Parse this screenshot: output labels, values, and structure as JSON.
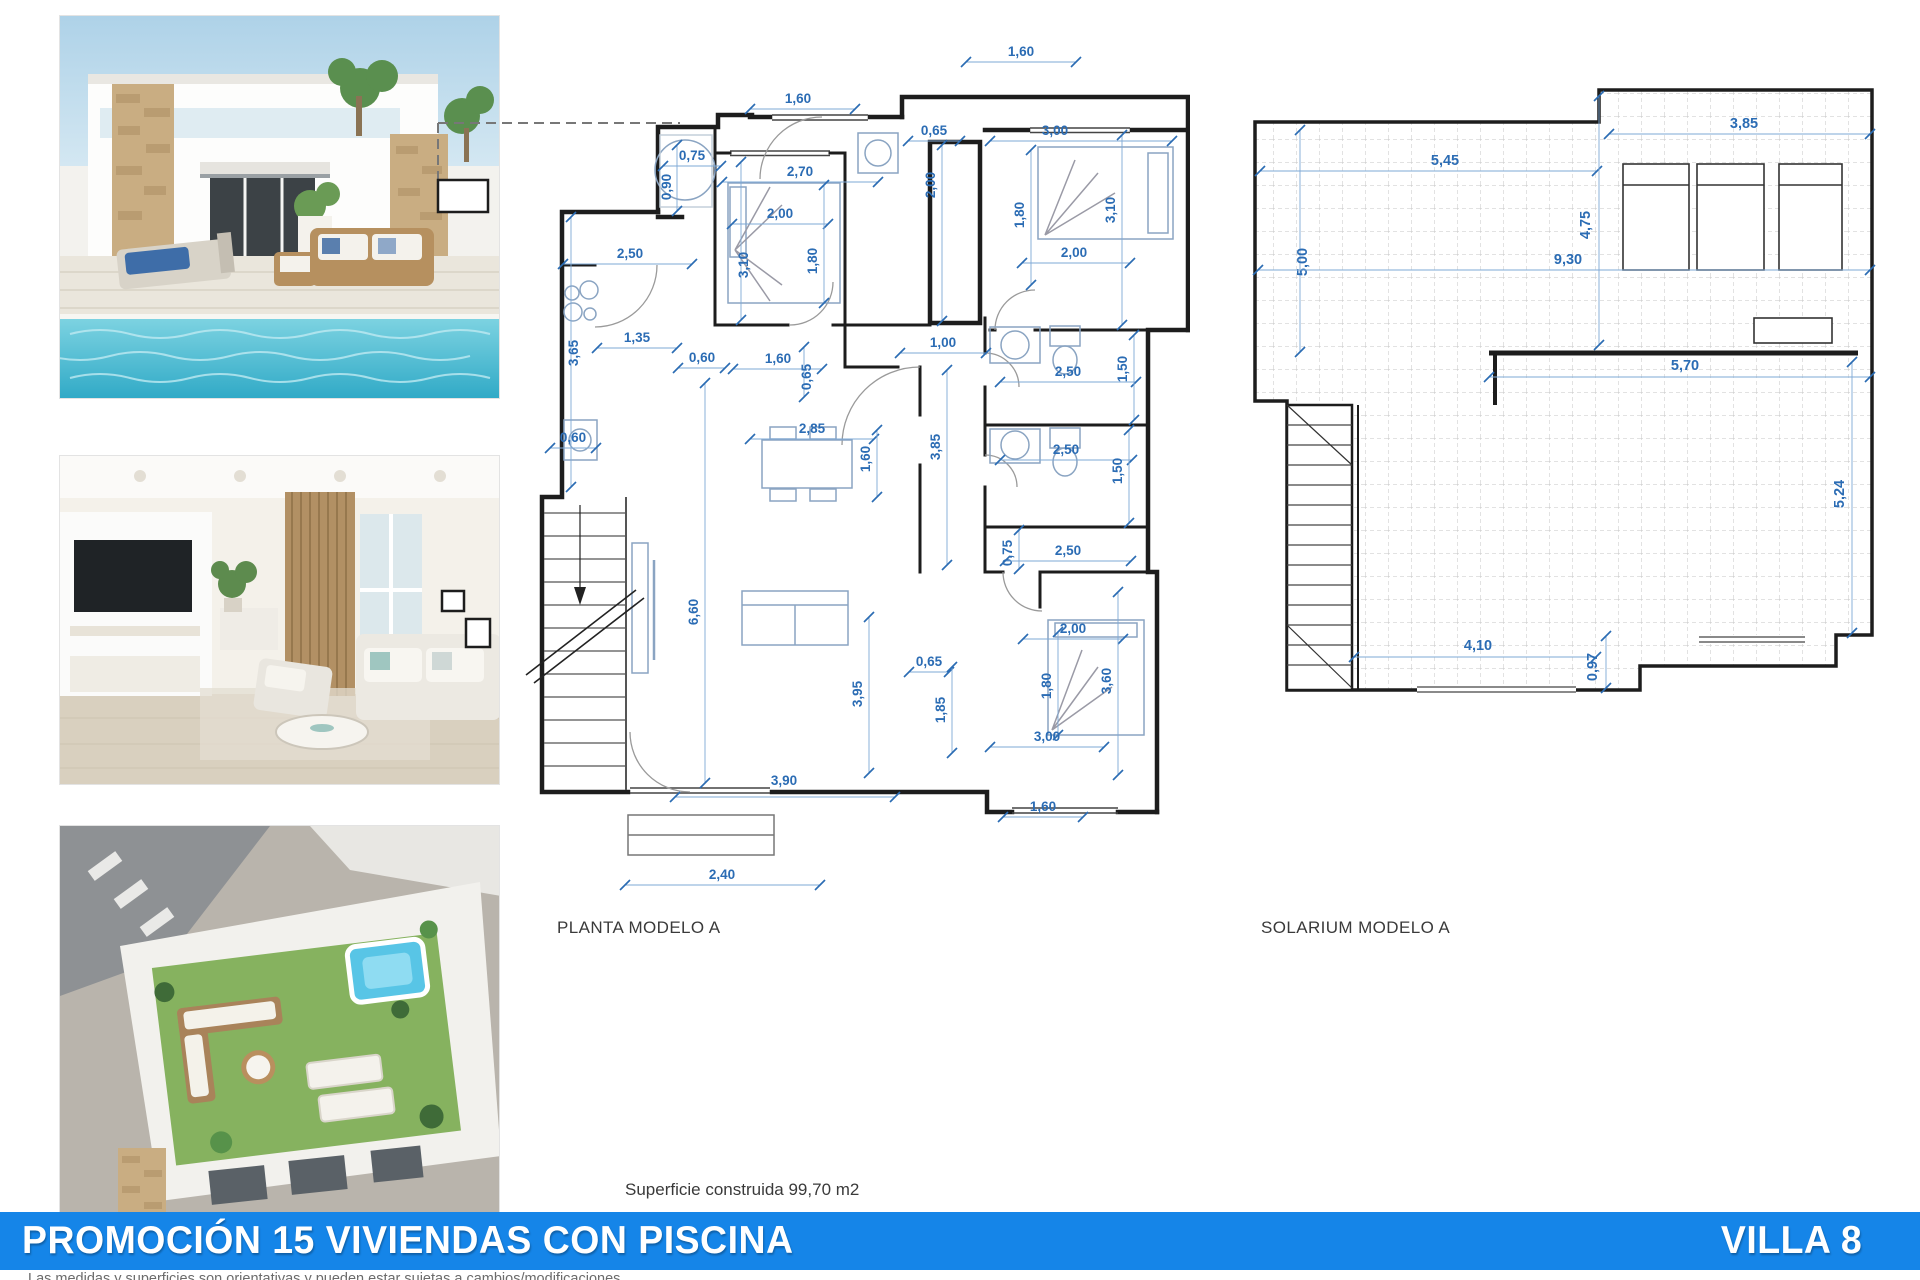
{
  "photos": [
    {
      "label": "villa-exterior-with-pool"
    },
    {
      "label": "living-room-interior"
    },
    {
      "label": "rooftop-solarium-aerial-view"
    }
  ],
  "planta": {
    "title": "PLANTA MODELO A",
    "scale_note": "dimensions in metres",
    "dims": [
      {
        "t": "1,60",
        "x": 591,
        "y": 21,
        "l": [
          536,
          27,
          646,
          27
        ]
      },
      {
        "t": "1,60",
        "x": 368,
        "y": 68,
        "l": [
          320,
          74,
          425,
          74
        ]
      },
      {
        "t": "0,65",
        "x": 504,
        "y": 100,
        "l": [
          478,
          106,
          530,
          106
        ]
      },
      {
        "t": "3,00",
        "x": 625,
        "y": 100,
        "l": [
          560,
          106,
          742,
          106
        ]
      },
      {
        "t": "0,75",
        "x": 262,
        "y": 125,
        "l": [
          233,
          131,
          291,
          131
        ]
      },
      {
        "t": "0,90",
        "x": 241,
        "y": 152,
        "r": -90,
        "l": [
          247,
          110,
          247,
          176
        ]
      },
      {
        "t": "2,70",
        "x": 370,
        "y": 141,
        "l": [
          292,
          147,
          448,
          147
        ]
      },
      {
        "t": "2,00",
        "x": 505,
        "y": 150,
        "r": -90,
        "l": [
          512,
          110,
          512,
          286
        ]
      },
      {
        "t": "1,80",
        "x": 594,
        "y": 180,
        "r": -90,
        "l": [
          601,
          115,
          601,
          250
        ]
      },
      {
        "t": "3,10",
        "x": 685,
        "y": 175,
        "r": -90,
        "l": [
          692,
          100,
          692,
          290
        ]
      },
      {
        "t": "2,00",
        "x": 644,
        "y": 222,
        "l": [
          592,
          228,
          700,
          228
        ]
      },
      {
        "t": "2,00",
        "x": 350,
        "y": 183,
        "l": [
          302,
          189,
          398,
          189
        ]
      },
      {
        "t": "3,10",
        "x": 318,
        "y": 230,
        "r": -90,
        "l": [
          311,
          127,
          311,
          285
        ]
      },
      {
        "t": "1,80",
        "x": 387,
        "y": 226,
        "r": -90,
        "l": [
          394,
          150,
          394,
          268
        ]
      },
      {
        "t": "2,50",
        "x": 200,
        "y": 223,
        "l": [
          133,
          229,
          262,
          229
        ]
      },
      {
        "t": "1,35",
        "x": 207,
        "y": 307,
        "l": [
          167,
          313,
          247,
          313
        ]
      },
      {
        "t": "3,65",
        "x": 148,
        "y": 318,
        "r": -90,
        "l": [
          141,
          182,
          141,
          452
        ]
      },
      {
        "t": "0,60",
        "x": 272,
        "y": 327,
        "l": [
          248,
          333,
          295,
          333
        ]
      },
      {
        "t": "1,60",
        "x": 348,
        "y": 328,
        "l": [
          303,
          334,
          392,
          334
        ]
      },
      {
        "t": "0,65",
        "x": 381,
        "y": 342,
        "r": -90,
        "l": [
          374,
          312,
          374,
          362
        ]
      },
      {
        "t": "1,00",
        "x": 513,
        "y": 312,
        "l": [
          470,
          318,
          556,
          318
        ]
      },
      {
        "t": "2,50",
        "x": 638,
        "y": 341,
        "l": [
          570,
          347,
          706,
          347
        ]
      },
      {
        "t": "1,50",
        "x": 697,
        "y": 334,
        "r": -90,
        "l": [
          704,
          300,
          704,
          385
        ]
      },
      {
        "t": "0,60",
        "x": 143,
        "y": 407,
        "l": [
          120,
          413,
          166,
          413
        ]
      },
      {
        "t": "2,85",
        "x": 382,
        "y": 398,
        "l": [
          320,
          404,
          444,
          404
        ]
      },
      {
        "t": "1,60",
        "x": 440,
        "y": 424,
        "r": -90,
        "l": [
          447,
          395,
          447,
          462
        ]
      },
      {
        "t": "3,85",
        "x": 510,
        "y": 412,
        "r": -90,
        "l": [
          517,
          335,
          517,
          530
        ]
      },
      {
        "t": "2,50",
        "x": 636,
        "y": 419,
        "l": [
          570,
          425,
          702,
          425
        ]
      },
      {
        "t": "1,50",
        "x": 692,
        "y": 436,
        "r": -90,
        "l": [
          699,
          395,
          699,
          488
        ]
      },
      {
        "t": "0,75",
        "x": 582,
        "y": 518,
        "r": -90,
        "l": [
          589,
          495,
          589,
          534
        ]
      },
      {
        "t": "2,50",
        "x": 638,
        "y": 520,
        "l": [
          575,
          526,
          701,
          526
        ]
      },
      {
        "t": "2,00",
        "x": 643,
        "y": 598,
        "l": [
          593,
          604,
          693,
          604
        ]
      },
      {
        "t": "1,80",
        "x": 621,
        "y": 651,
        "r": -90,
        "l": [
          628,
          597,
          628,
          700
        ]
      },
      {
        "t": "3,60",
        "x": 681,
        "y": 646,
        "r": -90,
        "l": [
          688,
          557,
          688,
          740
        ]
      },
      {
        "t": "3,00",
        "x": 617,
        "y": 706,
        "l": [
          560,
          712,
          674,
          712
        ]
      },
      {
        "t": "1,60",
        "x": 613,
        "y": 776,
        "l": [
          573,
          782,
          653,
          782
        ]
      },
      {
        "t": "0,65",
        "x": 499,
        "y": 631,
        "l": [
          479,
          637,
          519,
          637
        ]
      },
      {
        "t": "1,85",
        "x": 515,
        "y": 675,
        "r": -90,
        "l": [
          522,
          632,
          522,
          718
        ]
      },
      {
        "t": "3,95",
        "x": 432,
        "y": 659,
        "r": -90,
        "l": [
          439,
          582,
          439,
          738
        ]
      },
      {
        "t": "6,60",
        "x": 268,
        "y": 577,
        "r": -90,
        "l": [
          275,
          348,
          275,
          748
        ]
      },
      {
        "t": "3,90",
        "x": 354,
        "y": 750,
        "l": [
          245,
          762,
          465,
          762
        ]
      },
      {
        "t": "2,40",
        "x": 292,
        "y": 844,
        "l": [
          195,
          850,
          390,
          850
        ]
      }
    ]
  },
  "solarium": {
    "title": "SOLARIUM MODELO A",
    "dims": [
      {
        "t": "3,85",
        "x": 494,
        "y": 58,
        "l": [
          359,
          64,
          620,
          64
        ]
      },
      {
        "t": "5,45",
        "x": 195,
        "y": 95,
        "l": [
          10,
          101,
          347,
          101
        ]
      },
      {
        "t": "4,75",
        "x": 340,
        "y": 155,
        "r": -90,
        "l": [
          349,
          26,
          349,
          275
        ]
      },
      {
        "t": "5,00",
        "x": 57,
        "y": 192,
        "r": -90,
        "l": [
          50,
          60,
          50,
          282
        ]
      },
      {
        "t": "9,30",
        "x": 318,
        "y": 194,
        "l": [
          8,
          200,
          620,
          200
        ]
      },
      {
        "t": "5,70",
        "x": 435,
        "y": 300,
        "l": [
          239,
          307,
          620,
          307
        ]
      },
      {
        "t": "5,24",
        "x": 594,
        "y": 424,
        "r": -90,
        "l": [
          602,
          292,
          602,
          563
        ]
      },
      {
        "t": "4,10",
        "x": 228,
        "y": 580,
        "l": [
          104,
          587,
          346,
          587
        ]
      },
      {
        "t": "0,97",
        "x": 347,
        "y": 597,
        "r": -90,
        "l": [
          356,
          566,
          356,
          618
        ]
      }
    ]
  },
  "surface_note": "Superficie construida 99,70 m2",
  "footer": {
    "title": "PROMOCIÓN 15 VIVIENDAS CON PISCINA",
    "villa": "VILLA 8",
    "bar_color": "#1585e8"
  },
  "disclaimer": "Las medidas y superficies son orientativas y pueden estar sujetas a cambios/modificaciones",
  "colors": {
    "dimension_blue": "#2b6cb4",
    "wall_black": "#1d1d1d",
    "furniture_blue_gray": "#8aa4c2",
    "pool_turquoise": "#3fb9d3",
    "lawn_green": "#86b25f"
  }
}
